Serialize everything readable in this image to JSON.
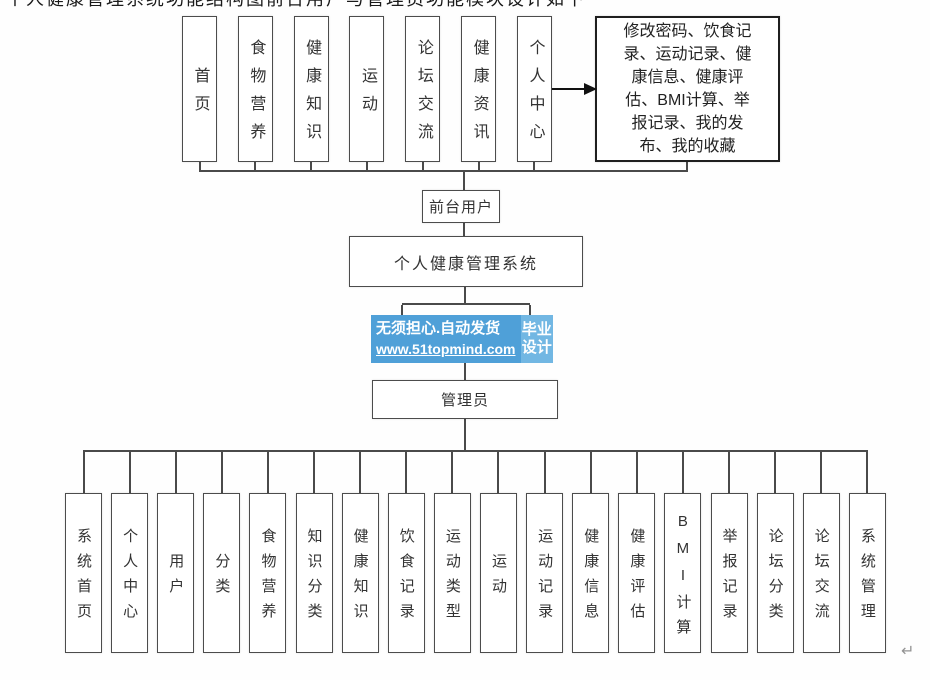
{
  "frontend": {
    "modules": [
      "首页",
      "食物营养",
      "健康知识",
      "运动",
      "论坛交流",
      "健康资讯",
      "个人中心"
    ],
    "personal_center_detail": "修改密码、饮食记\n录、运动记录、健\n康信息、健康评\n估、BMI计算、举\n报记录、我的发\n布、我的收藏",
    "role_label": "前台用户"
  },
  "system": {
    "title": "个人健康管理系统"
  },
  "backend": {
    "role_label": "管理员",
    "modules": [
      "系统首页",
      "个人中心",
      "用户",
      "分类",
      "食物营养",
      "知识分类",
      "健康知识",
      "饮食记录",
      "运动类型",
      "运动",
      "运动记录",
      "健康信息",
      "健康评估",
      "BMI计算",
      "举报记录",
      "论坛分类",
      "论坛交流",
      "系统管理"
    ]
  },
  "watermark": {
    "slogan": "无须担心.自动发货",
    "url": "www.51topmind.com",
    "badge": "毕业\n设计",
    "main_color": "#4FA0D8",
    "badge_color": "#72B7E3"
  },
  "artifacts": {
    "clipped_text_line": "个人健康管理系统功能结构图前台用户与管理员功能模块设计如下",
    "return_mark": "↵"
  },
  "colors": {
    "line": "#4a4a4a",
    "box_border": "#4c4c4c",
    "detail_border": "#1f1f1f"
  }
}
